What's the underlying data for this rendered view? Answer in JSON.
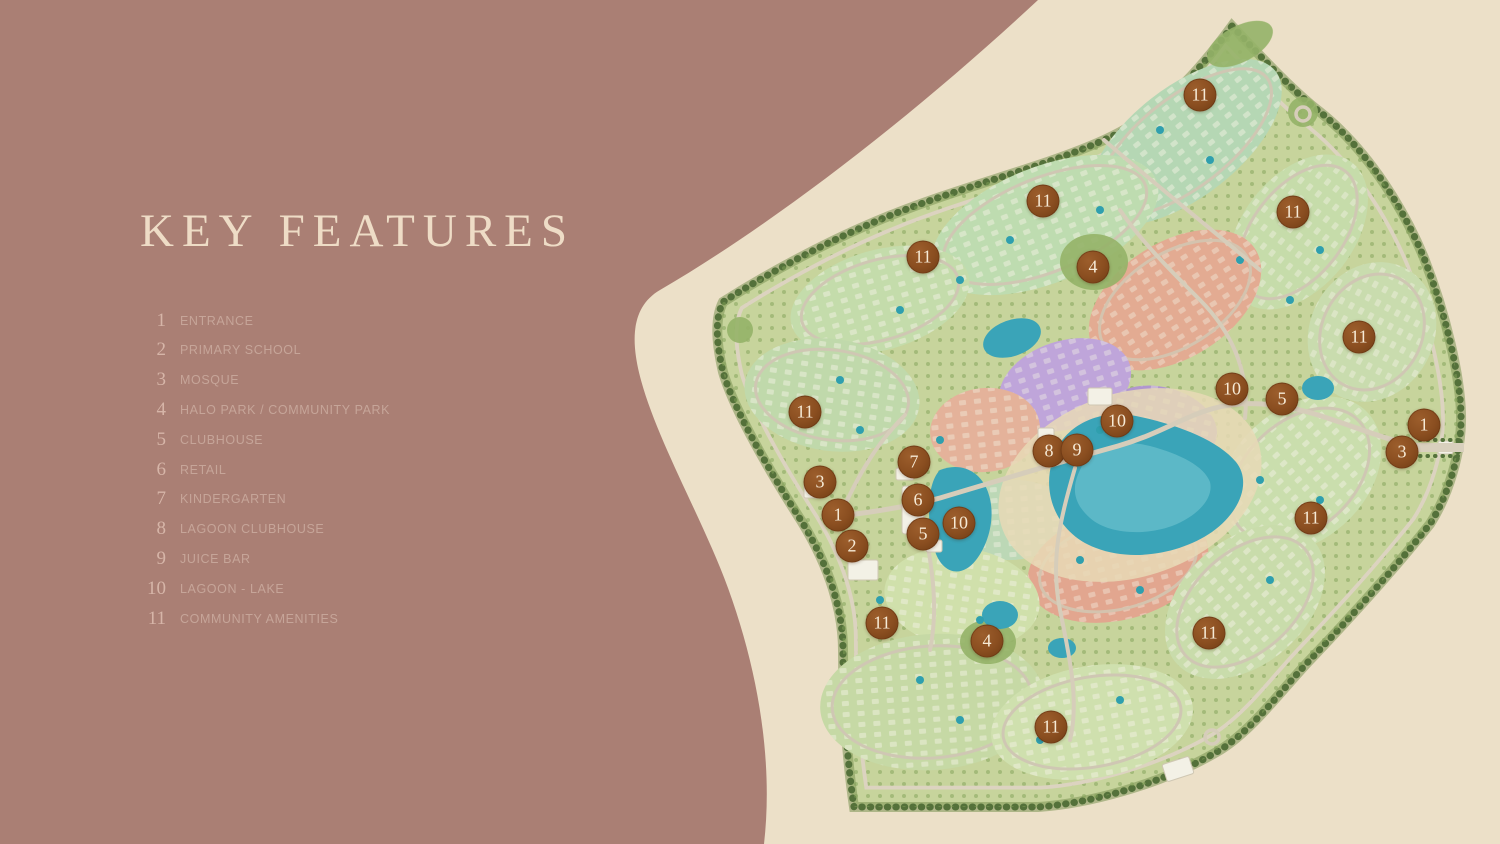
{
  "colors": {
    "background": "#aa7f74",
    "panel": "#ece0c8",
    "title_text": "#eedcc6",
    "legend_number": "#d6b5a8",
    "legend_label": "#c6a599",
    "marker": "#8a4e20",
    "marker_text": "#f6ead6",
    "map_green": "#c7d49c",
    "map_water": "#3aa4b8"
  },
  "legend": {
    "title": "KEY FEATURES",
    "items": [
      {
        "number": "1",
        "label": "ENTRANCE"
      },
      {
        "number": "2",
        "label": "PRIMARY SCHOOL"
      },
      {
        "number": "3",
        "label": "MOSQUE"
      },
      {
        "number": "4",
        "label": "HALO PARK / COMMUNITY PARK"
      },
      {
        "number": "5",
        "label": "CLUBHOUSE"
      },
      {
        "number": "6",
        "label": "RETAIL"
      },
      {
        "number": "7",
        "label": "KINDERGARTEN"
      },
      {
        "number": "8",
        "label": "LAGOON CLUBHOUSE"
      },
      {
        "number": "9",
        "label": "JUICE BAR"
      },
      {
        "number": "10",
        "label": "LAGOON - LAKE"
      },
      {
        "number": "11",
        "label": "COMMUNITY AMENITIES"
      }
    ]
  },
  "map": {
    "name": "community-master-plan",
    "markers": [
      {
        "label": "11",
        "x": 1200,
        "y": 95
      },
      {
        "label": "11",
        "x": 1043,
        "y": 201
      },
      {
        "label": "11",
        "x": 1293,
        "y": 212
      },
      {
        "label": "11",
        "x": 923,
        "y": 257
      },
      {
        "label": "4",
        "x": 1093,
        "y": 267
      },
      {
        "label": "11",
        "x": 1359,
        "y": 337
      },
      {
        "label": "10",
        "x": 1232,
        "y": 389
      },
      {
        "label": "5",
        "x": 1282,
        "y": 399
      },
      {
        "label": "11",
        "x": 805,
        "y": 412
      },
      {
        "label": "10",
        "x": 1117,
        "y": 421
      },
      {
        "label": "1",
        "x": 1424,
        "y": 425
      },
      {
        "label": "8",
        "x": 1049,
        "y": 451
      },
      {
        "label": "9",
        "x": 1077,
        "y": 450
      },
      {
        "label": "3",
        "x": 1402,
        "y": 452
      },
      {
        "label": "7",
        "x": 914,
        "y": 462
      },
      {
        "label": "3",
        "x": 820,
        "y": 482
      },
      {
        "label": "6",
        "x": 918,
        "y": 500
      },
      {
        "label": "1",
        "x": 838,
        "y": 515
      },
      {
        "label": "11",
        "x": 1311,
        "y": 518
      },
      {
        "label": "10",
        "x": 959,
        "y": 523
      },
      {
        "label": "5",
        "x": 923,
        "y": 534
      },
      {
        "label": "2",
        "x": 852,
        "y": 546
      },
      {
        "label": "11",
        "x": 882,
        "y": 623
      },
      {
        "label": "4",
        "x": 987,
        "y": 641
      },
      {
        "label": "11",
        "x": 1209,
        "y": 633
      },
      {
        "label": "11",
        "x": 1051,
        "y": 727
      }
    ]
  }
}
